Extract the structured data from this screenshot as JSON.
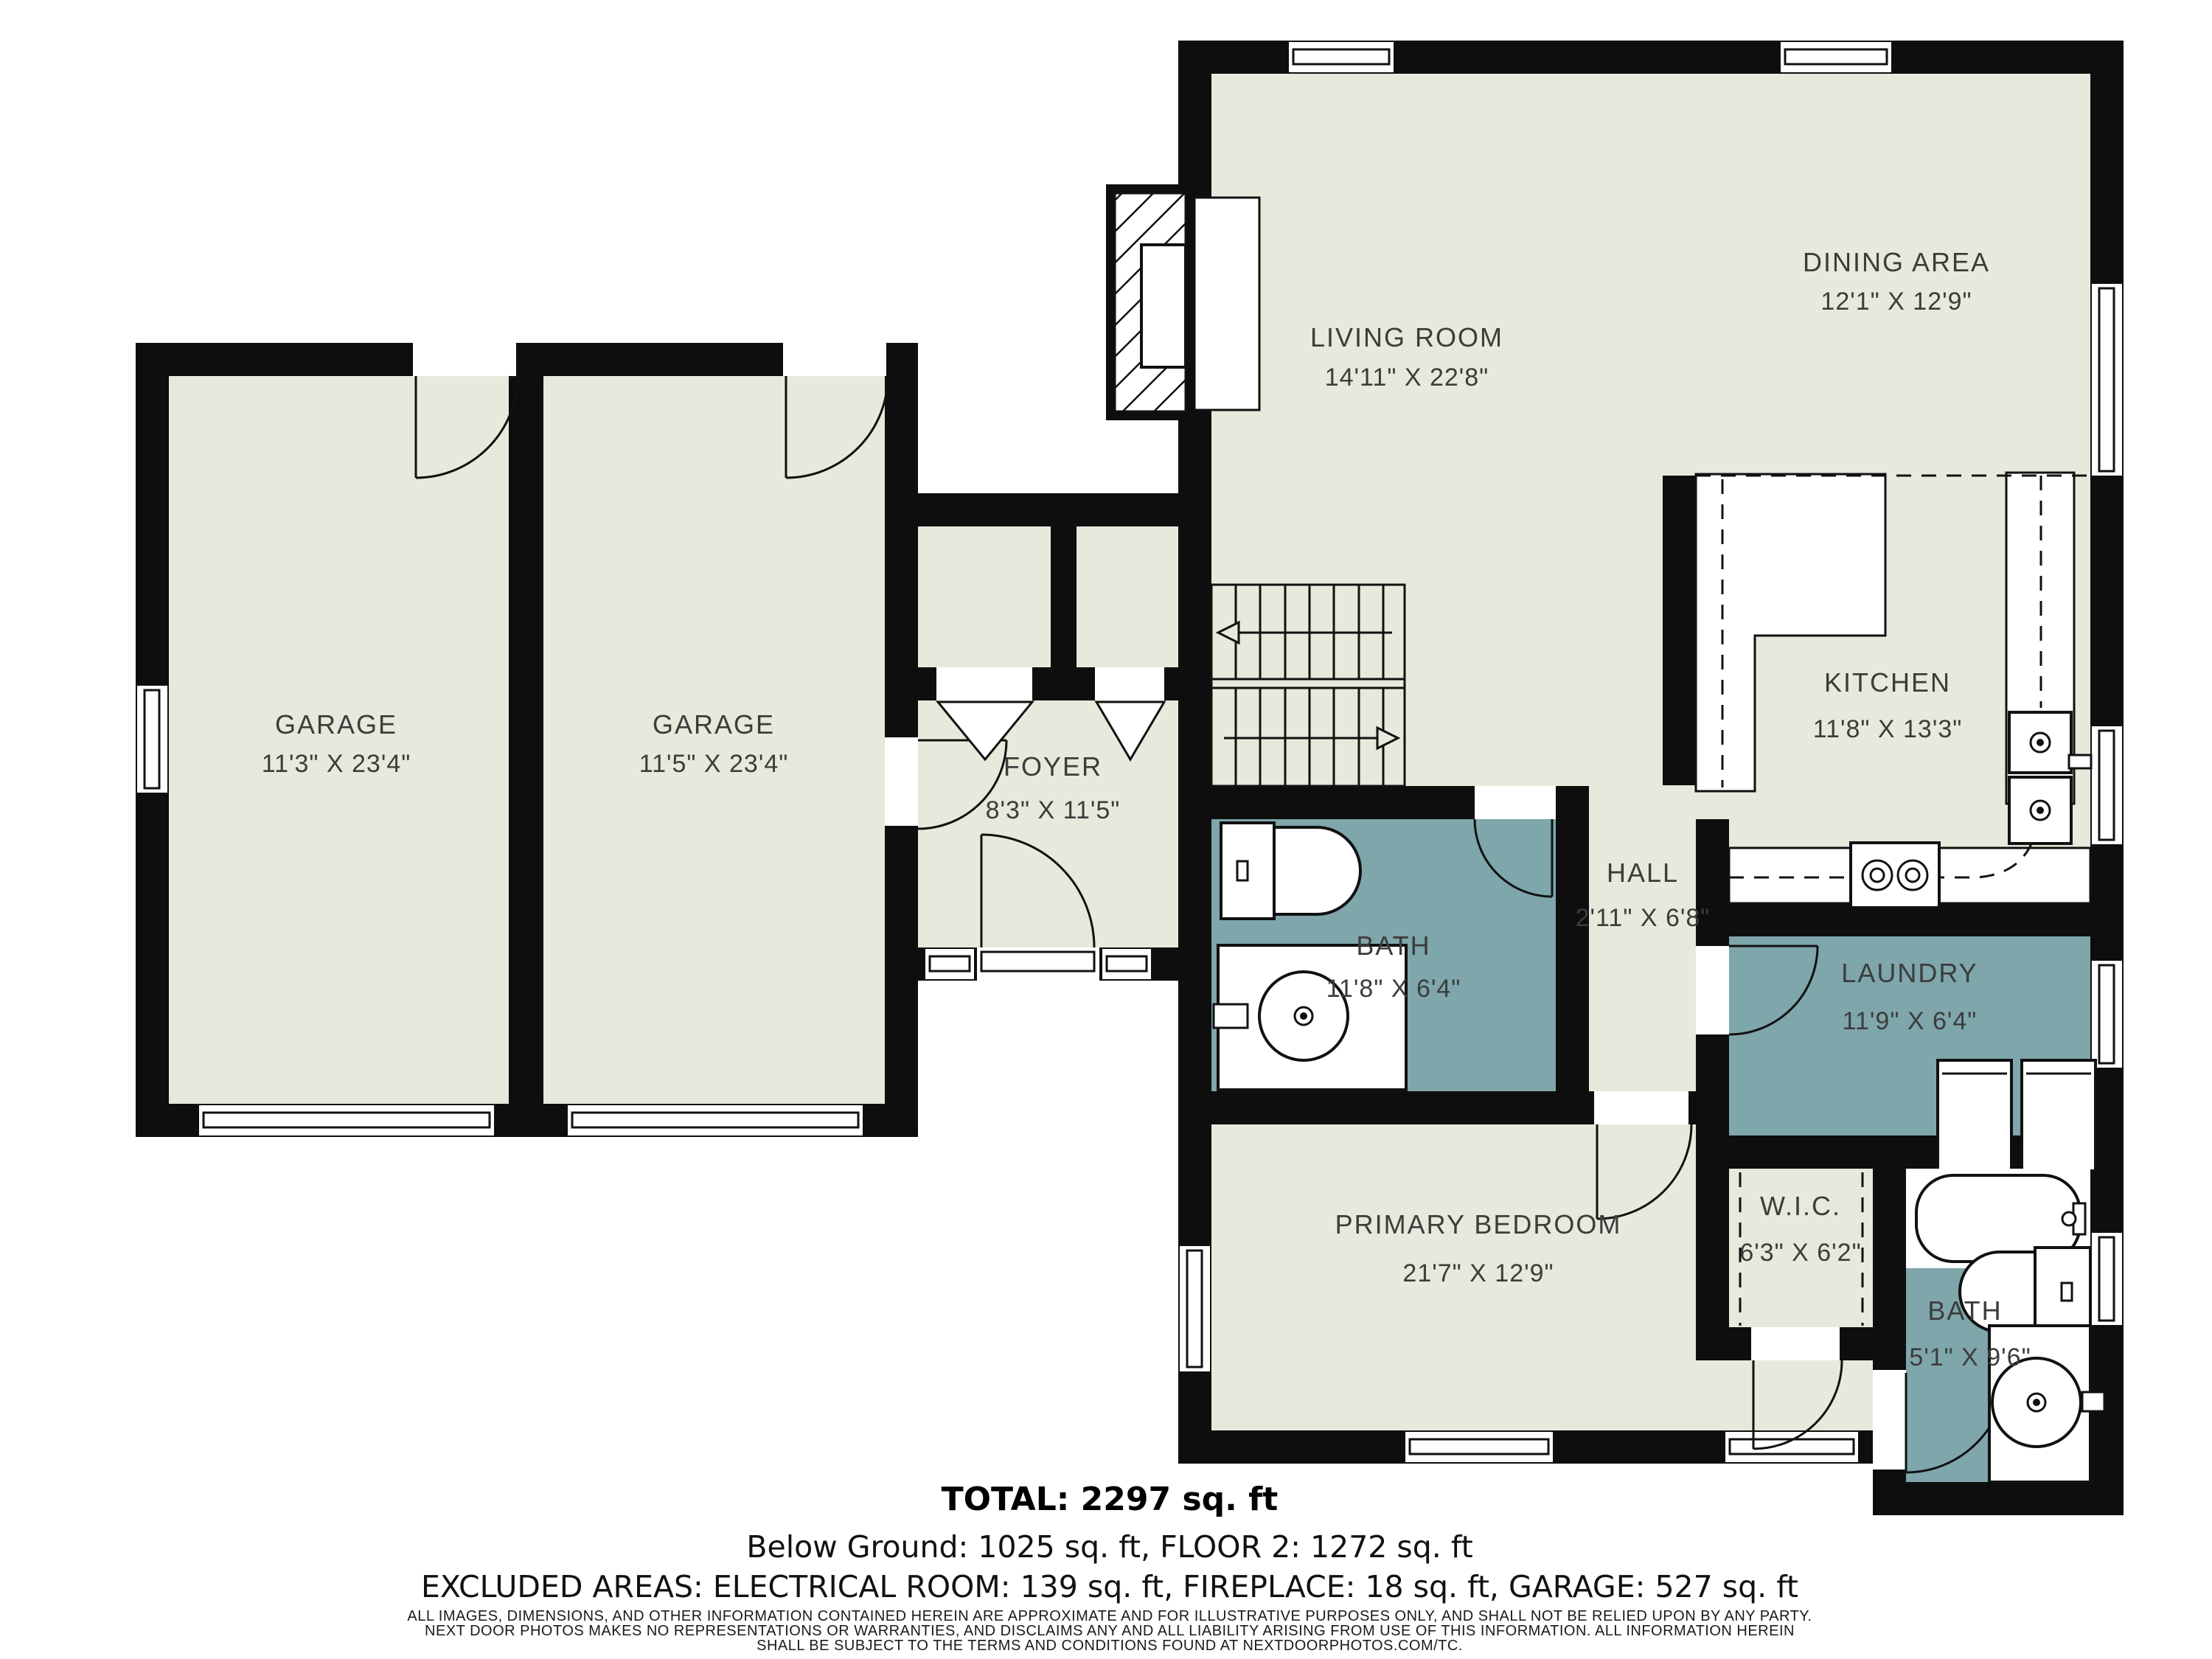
{
  "fp": {
    "rooms": [
      {
        "id": "garage-1",
        "name": "GARAGE",
        "dims": "11'3\" X 23'4\""
      },
      {
        "id": "garage-2",
        "name": "GARAGE",
        "dims": "11'5\" X 23'4\""
      },
      {
        "id": "living-room",
        "name": "LIVING ROOM",
        "dims": "14'11\" X 22'8\""
      },
      {
        "id": "dining-area",
        "name": "DINING AREA",
        "dims": "12'1\" X 12'9\""
      },
      {
        "id": "kitchen",
        "name": "KITCHEN",
        "dims": "11'8\" X 13'3\""
      },
      {
        "id": "foyer",
        "name": "FOYER",
        "dims": "8'3\" X 11'5\""
      },
      {
        "id": "bath-main",
        "name": "BATH",
        "dims": "11'8\" X 6'4\""
      },
      {
        "id": "hall",
        "name": "HALL",
        "dims": "2'11\" X 6'8\""
      },
      {
        "id": "laundry",
        "name": "LAUNDRY",
        "dims": "11'9\" X 6'4\""
      },
      {
        "id": "primary-bedroom",
        "name": "PRIMARY BEDROOM",
        "dims": "21'7\" X 12'9\""
      },
      {
        "id": "wic",
        "name": "W.I.C.",
        "dims": "6'3\" X 6'2\""
      },
      {
        "id": "bath-2",
        "name": "BATH",
        "dims": "5'1\" X 9'6\""
      }
    ],
    "footer": {
      "total": "TOTAL: 2297 sq. ft",
      "line2": "Below Ground: 1025 sq. ft, FLOOR 2: 1272 sq. ft",
      "line3": "EXCLUDED AREAS: ELECTRICAL ROOM: 139 sq. ft, FIREPLACE: 18 sq. ft, GARAGE: 527 sq. ft"
    },
    "disclaimer": {
      "l1": "ALL IMAGES, DIMENSIONS, AND OTHER INFORMATION CONTAINED HEREIN ARE APPROXIMATE AND FOR ILLUSTRATIVE PURPOSES ONLY, AND SHALL NOT BE RELIED UPON BY ANY PARTY.",
      "l2": "NEXT DOOR PHOTOS MAKES NO REPRESENTATIONS OR WARRANTIES, AND DISCLAIMS ANY AND ALL LIABILITY ARISING FROM USE OF THIS INFORMATION. ALL INFORMATION HEREIN",
      "l3": "SHALL BE SUBJECT TO THE TERMS AND CONDITIONS FOUND AT NEXTDOORPHOTOS.COM/TC."
    },
    "colors": {
      "wall": "#0e0e0e",
      "floor": "#e9e8dc",
      "wet_room_accent": "#7ea6ab",
      "background": "#ffffff",
      "label_text": "#3c3c3c"
    }
  }
}
